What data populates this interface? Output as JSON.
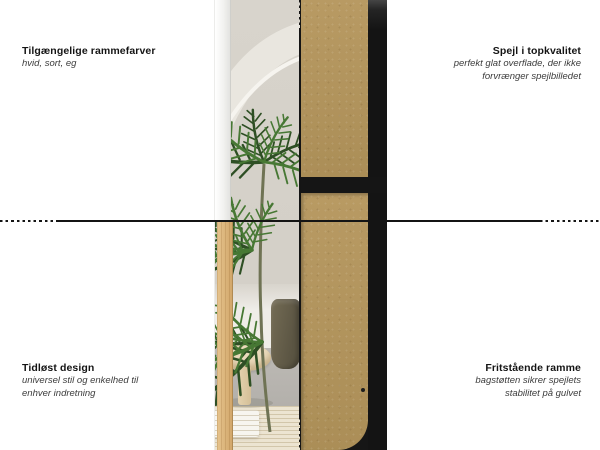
{
  "annotations": {
    "top_left": {
      "title": "Tilgængelige rammefarver",
      "subtitle_lines": [
        "hvid, sort, eg"
      ]
    },
    "top_right": {
      "title": "Spejl i topkvalitet",
      "subtitle_lines": [
        "perfekt glat overflade, der ikke",
        "forvrænger spejlbilledet"
      ]
    },
    "bottom_left": {
      "title": "Tidløst design",
      "subtitle_lines": [
        "universel stil og enkelhed til",
        "enhver indretning"
      ]
    },
    "bottom_right": {
      "title": "Fritstående ramme",
      "subtitle_lines": [
        "bagstøtten sikrer spejlets",
        "stabilitet på gulvet"
      ]
    }
  },
  "illustration": {
    "left_panel": "mirror-front-photo-with-palm-reflection",
    "right_panel": "mirror-back-mdf-board-with-black-frame",
    "frame_colors_shown": [
      "hvid",
      "eg",
      "sort"
    ],
    "colors": {
      "mdf_board": "#b2945d",
      "black_frame": "#161616",
      "oak_frame": "#d2a76b",
      "white_frame": "#f2f2f0",
      "wall_greige": "#d6d2ca",
      "palm_green": "#477834",
      "divider_line": "#141414",
      "page_background": "#ffffff"
    }
  }
}
